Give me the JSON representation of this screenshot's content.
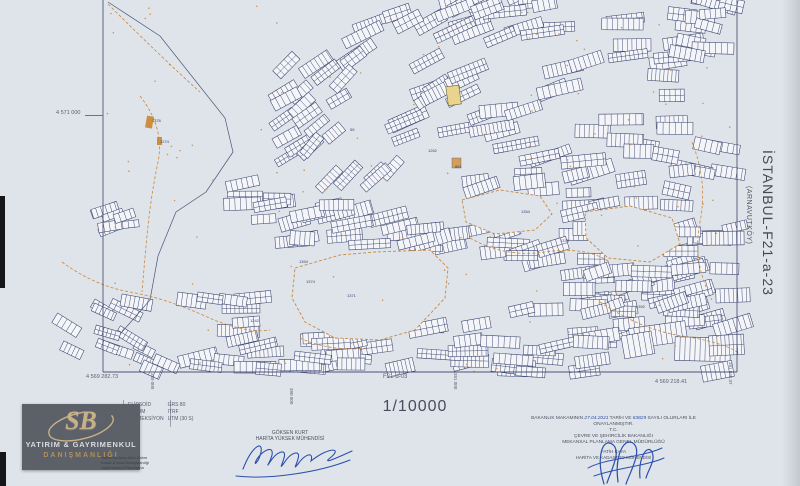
{
  "sheet": {
    "title": "İSTANBUL-F21-a-23",
    "subtitle": "(ARNAVUTKÖY)",
    "scale": "1/10000",
    "sheet_label_bottom": "F21-d-03",
    "coord_top_left": "4 571 000",
    "coord_bottom_left": "4 569 282.73",
    "coord_bottom_right": "4 569 218.41",
    "eastings": [
      {
        "text": "389 000"
      },
      {
        "text": "390 000"
      },
      {
        "text": "391 000"
      },
      {
        "text": "391 842.37"
      }
    ]
  },
  "datum_block": {
    "rows": [
      {
        "label": "ELİPSOİD",
        "value": "GRS 80"
      },
      {
        "label": "DATUM",
        "value": "ITRF"
      },
      {
        "label": "PROJEKSİYON",
        "value": "UTM (30 S)"
      }
    ]
  },
  "surveyor": {
    "name": "GÖKSEN KURT",
    "title": "HARİTA YÜKSEK MÜHENDİSİ"
  },
  "approval": {
    "line1_prefix": "BAKANLIK MAKAMININ",
    "date": "27.04.2021",
    "line1_mid": "TARİH VE",
    "number": "83829",
    "line1_suffix": "SAYILI OLURLARI İLE ONAYLANMIŞTIR.",
    "org1": "T.C.",
    "org2": "ÇEVRE VE ŞEHİRCİLİK BAKANLIĞI",
    "org3": "MEKANSAL PLANLAMA GENEL MÜDÜRLÜĞÜ",
    "signer_name": "FATİH KAYA",
    "signer_title": "HARİTA VE KADASTRO MÜHENDİSİ"
  },
  "watermark": {
    "monogram": "SB",
    "line1": "YATIRIM & GAYRIMENKUL",
    "line2": "DANIŞMANLIĞI",
    "services": [
      "Yatırımlık Arsa Alım Satım",
      "Konut & Arsa Danışmanlığı",
      "Gayrimenkul Pazarlama"
    ]
  },
  "map_labels": [
    {
      "t": "55",
      "x": 350,
      "y": 131
    },
    {
      "t": "1371",
      "x": 347,
      "y": 297
    },
    {
      "t": "1394",
      "x": 299,
      "y": 263
    },
    {
      "t": "1374",
      "x": 306,
      "y": 283
    },
    {
      "t": "1354",
      "x": 521,
      "y": 213
    },
    {
      "t": "1378",
      "x": 560,
      "y": 242
    },
    {
      "t": "1376",
      "x": 152,
      "y": 122
    },
    {
      "t": "1274",
      "x": 160,
      "y": 143
    },
    {
      "t": "1262",
      "x": 428,
      "y": 152
    },
    {
      "t": "1242",
      "x": 250,
      "y": 322
    },
    {
      "t": "1392",
      "x": 636,
      "y": 308
    },
    {
      "t": "861",
      "x": 455,
      "y": 168
    }
  ],
  "colors": {
    "paper": "#dfe4ea",
    "parcel_line": "#39426e",
    "parcel_fill": "#f3f5f8",
    "contour_orange": "#c9883b",
    "ink_blue": "#2b4fae",
    "logo_gold": "#c9b086",
    "frame": "#4a5578"
  }
}
